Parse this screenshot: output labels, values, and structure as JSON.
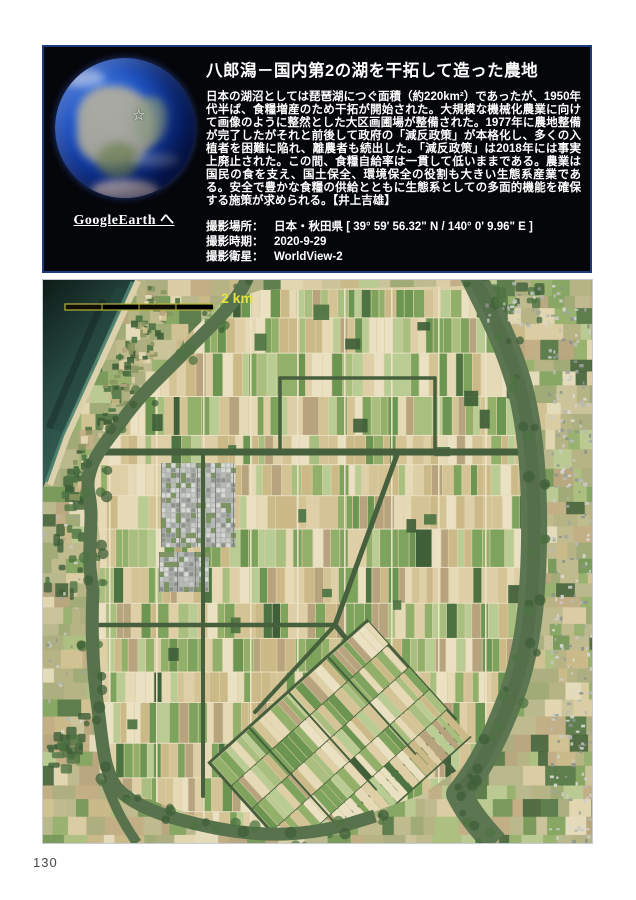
{
  "page": {
    "number": "130",
    "background": "#ffffff"
  },
  "header": {
    "title": "八郎潟－国内第2の湖を干拓して造った農地",
    "body": "日本の湖沼としては琵琶湖につぐ面積（約220km²）であったが、1950年代半ば、食糧増産のため干拓が開始された。大規模な機械化農業に向けて画像のように整然とした大区画圃場が整備された。1977年に農地整備が完了したがそれと前後して政府の「減反政策」が本格化し、多くの入植者を困難に陥れ、離農者も続出した。「減反政策」は2018年には事実上廃止された。この間、食糧自給率は一貫して低いままである。農業は国民の食を支え、国土保全、環境保全の役割も大きい生態系産業である。安全で豊かな食糧の供給とともに生態系としての多面的機能を確保する施策が求められる。【井上吉雄】",
    "globe_link": "GoogleEarth へ",
    "star_glyph": "☆",
    "meta": [
      {
        "label": "撮影場所：",
        "value": "日本・秋田県  [ 39° 59' 56.32\" N / 140° 0' 9.96\" E ]"
      },
      {
        "label": "撮影時期：",
        "value": "2020-9-29"
      },
      {
        "label": "撮影衛星：",
        "value": "WorldView-2"
      }
    ],
    "colors": {
      "background": "#05060a",
      "border": "#1c3a7c",
      "text": "#ffffff"
    }
  },
  "satellite": {
    "scale_bar_label": "2 km",
    "palette": {
      "sea_deep": "#0d1b17",
      "sea_mid": "#26483f",
      "sea_near": "#3c685a",
      "beach": "#dbd2ad",
      "shallow": "#4f8272",
      "channel": "#57724d",
      "channel_wide": "#5d7652",
      "channel_core": "#516a48",
      "road_dark": "#46603e",
      "pale_road": "#ece4c8",
      "polder_base": "#dcd0a8",
      "outer_base": "#c1ba90",
      "scale_color": "#e8e23c",
      "field_tan": [
        "#decfa7",
        "#e6dab6",
        "#d4c394",
        "#eae0c2",
        "#cbb988",
        "#b7a37e"
      ],
      "field_green": [
        "#a9bf7f",
        "#93b06a",
        "#7ea35d",
        "#b9cc93",
        "#6d9552"
      ],
      "field_dark": [
        "#4d7342",
        "#3f5f38"
      ],
      "outskirt": [
        "#c0bb8f",
        "#cdc49b",
        "#b4b183",
        "#a9ad7e",
        "#c2ad85",
        "#9aa873",
        "#b8b88e"
      ],
      "town": [
        "#b7bab6",
        "#c9cbc7",
        "#9fa49e",
        "#d8d9d4",
        "#8d938c"
      ]
    }
  }
}
